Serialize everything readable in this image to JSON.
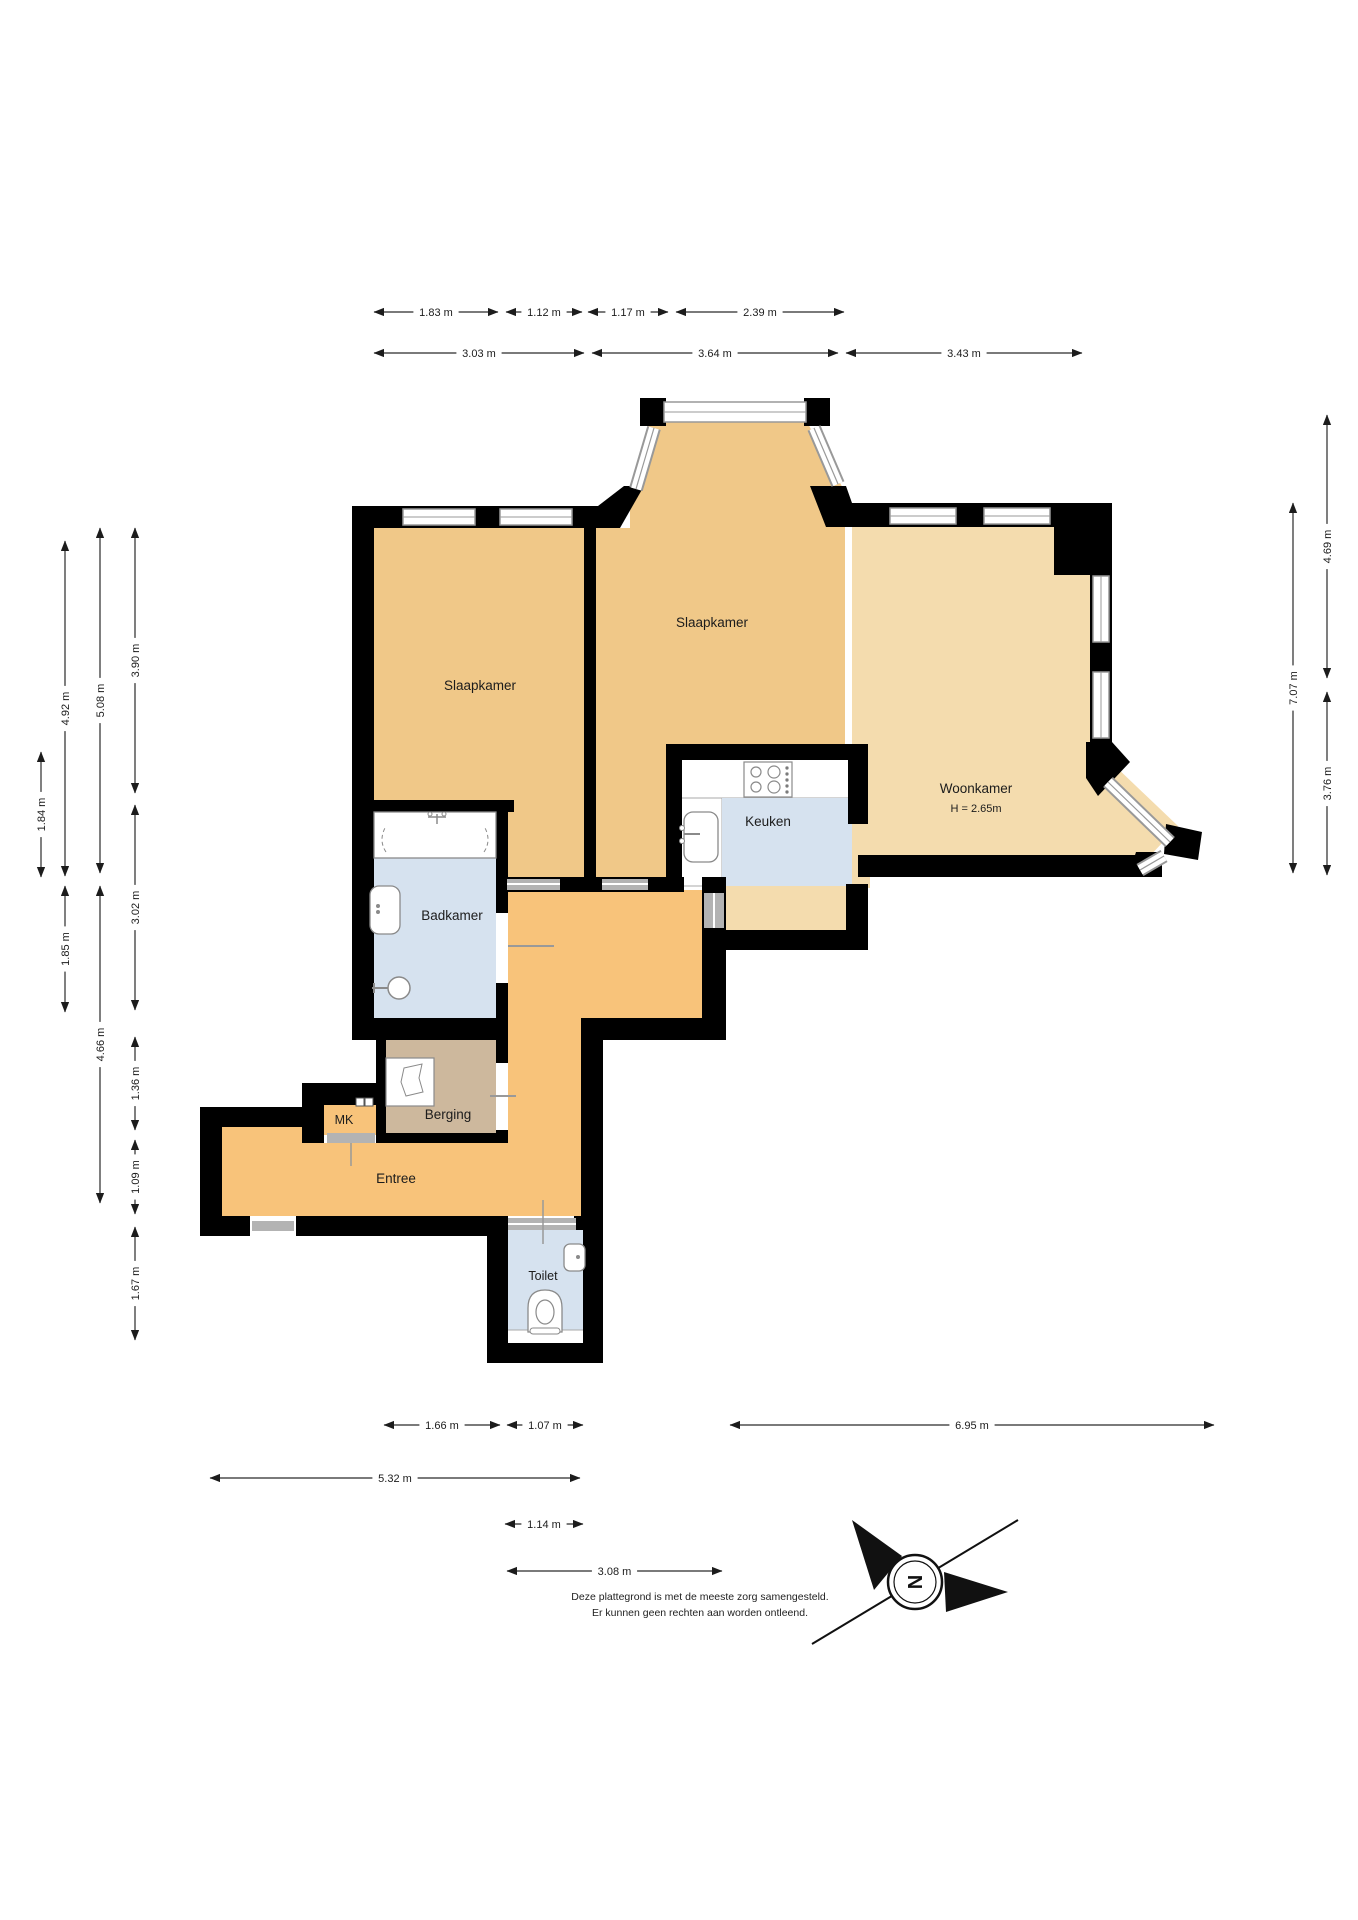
{
  "rooms": [
    {
      "id": "slaapkamer-1",
      "label": "Slaapkamer",
      "x": 480,
      "y": 690,
      "size": 13.5
    },
    {
      "id": "slaapkamer-2",
      "label": "Slaapkamer",
      "x": 712,
      "y": 627,
      "size": 13.5
    },
    {
      "id": "woonkamer",
      "label": "Woonkamer",
      "x": 976,
      "y": 793,
      "size": 13.5,
      "sub": "H = 2.65m",
      "subx": 976,
      "suby": 812,
      "subsize": 11
    },
    {
      "id": "keuken",
      "label": "Keuken",
      "x": 768,
      "y": 826,
      "size": 13.5
    },
    {
      "id": "badkamer",
      "label": "Badkamer",
      "x": 452,
      "y": 920,
      "size": 13.5
    },
    {
      "id": "berging",
      "label": "Berging",
      "x": 448,
      "y": 1119,
      "size": 13.5
    },
    {
      "id": "mk",
      "label": "MK",
      "x": 344,
      "y": 1124,
      "size": 12.5
    },
    {
      "id": "entree",
      "label": "Entree",
      "x": 396,
      "y": 1183,
      "size": 13.5
    },
    {
      "id": "toilet",
      "label": "Toilet",
      "x": 543,
      "y": 1280,
      "size": 12.5
    }
  ],
  "dimensions": {
    "horizontal": [
      {
        "y": 312,
        "from": 374,
        "to": 498,
        "label": "1.83 m"
      },
      {
        "y": 312,
        "from": 506,
        "to": 582,
        "label": "1.12 m"
      },
      {
        "y": 312,
        "from": 588,
        "to": 668,
        "label": "1.17 m"
      },
      {
        "y": 312,
        "from": 676,
        "to": 844,
        "label": "2.39 m"
      },
      {
        "y": 353,
        "from": 374,
        "to": 584,
        "label": "3.03 m"
      },
      {
        "y": 353,
        "from": 592,
        "to": 838,
        "label": "3.64 m"
      },
      {
        "y": 353,
        "from": 846,
        "to": 1082,
        "label": "3.43 m"
      },
      {
        "y": 1425,
        "from": 384,
        "to": 500,
        "label": "1.66 m"
      },
      {
        "y": 1425,
        "from": 507,
        "to": 583,
        "label": "1.07 m"
      },
      {
        "y": 1425,
        "from": 730,
        "to": 1214,
        "label": "6.95 m"
      },
      {
        "y": 1478,
        "from": 210,
        "to": 580,
        "label": "5.32 m"
      },
      {
        "y": 1524,
        "from": 505,
        "to": 583,
        "label": "1.14 m"
      },
      {
        "y": 1571,
        "from": 507,
        "to": 722,
        "label": "3.08 m"
      }
    ],
    "vertical": [
      {
        "x": 41,
        "from": 752,
        "to": 877,
        "label": "1.84 m"
      },
      {
        "x": 65,
        "from": 541,
        "to": 876,
        "label": "4.92 m"
      },
      {
        "x": 65,
        "from": 886,
        "to": 1012,
        "label": "1.85 m"
      },
      {
        "x": 100,
        "from": 528,
        "to": 873,
        "label": "5.08 m"
      },
      {
        "x": 100,
        "from": 886,
        "to": 1203,
        "label": "4.66 m"
      },
      {
        "x": 135,
        "from": 528,
        "to": 793,
        "label": "3.90 m"
      },
      {
        "x": 135,
        "from": 805,
        "to": 1010,
        "label": "3.02 m"
      },
      {
        "x": 135,
        "from": 1037,
        "to": 1130,
        "label": "1.36 m"
      },
      {
        "x": 135,
        "from": 1140,
        "to": 1214,
        "label": "1.09 m"
      },
      {
        "x": 135,
        "from": 1227,
        "to": 1340,
        "label": "1.67 m"
      },
      {
        "x": 1293,
        "from": 503,
        "to": 873,
        "label": "7.07 m"
      },
      {
        "x": 1327,
        "from": 415,
        "to": 678,
        "label": "4.69 m"
      },
      {
        "x": 1327,
        "from": 692,
        "to": 875,
        "label": "3.76 m"
      }
    ]
  },
  "disclaimer": {
    "line1": "Deze plattegrond is met de meeste zorg samengesteld.",
    "line2": "Er kunnen geen rechten aan worden ontleend."
  },
  "compass": {
    "letter": "N"
  },
  "colors": {
    "wall": "#000000",
    "bedroom": "#F0C888",
    "living": "#F4DCAE",
    "wet": "#D6E2EF",
    "storage": "#CDB89D",
    "hall": "#F8C37A",
    "window": "#999999",
    "door": "#b3b3b3",
    "dim": "#2a2a2a"
  }
}
